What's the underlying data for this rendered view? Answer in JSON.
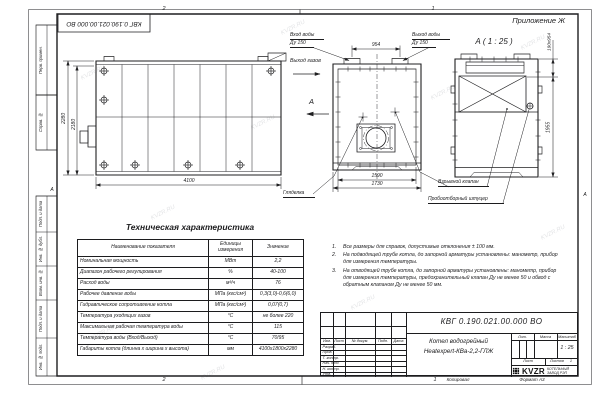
{
  "watermark": "KVZR.RU",
  "frame": {
    "doc_number_top": "КВГ 0.190.021.00.000 ВО",
    "appendix": "Приложение Ж",
    "zones": {
      "top_left": "2",
      "top_right": "1",
      "bottom_left": "2",
      "bottom_right": "1",
      "row_letter_left": "А",
      "row_letter_right": "А"
    },
    "margin_labels": [
      "Перв. примен.",
      "Справ. №",
      "Подп. и дата",
      "Инв. № дубл.",
      "Взам. инв. №",
      "Подп. и дата",
      "Инв. № подл."
    ]
  },
  "drawing": {
    "section_view_title": "А ( 1 : 25 )",
    "section_arrow_label": "А",
    "callouts": {
      "water_inlet_line1": "Вход воды",
      "water_inlet_line2": "Ду 150",
      "water_outlet_line1": "Выход воды",
      "water_outlet_line2": "Ду 150",
      "gas_outlet": "Выход газов",
      "sight_glass": "Гляделка",
      "explosion_valve": "Взрывной клапан",
      "sampling_fitting": "Пробоотборный штуцер"
    },
    "dimensions": {
      "nozzle_spacing": "954",
      "height_overall": "2280",
      "height_body": "2180",
      "length_overall": "4100",
      "front_width_inner": "1590",
      "front_width_overall": "1730",
      "valve_size": "190х954",
      "rear_height": "1955"
    }
  },
  "spec_table": {
    "title": "Техническая характеристика",
    "headers": {
      "name": "Наименование показателя",
      "units_line1": "Единицы",
      "units_line2": "измерения",
      "value": "Значение"
    },
    "rows": [
      {
        "name": "Номинальная мощность",
        "units": "МВт",
        "value": "2,2"
      },
      {
        "name": "Диапазон рабочего регулирования",
        "units": "%",
        "value": "40-100"
      },
      {
        "name": "Расход воды",
        "units": "м³/ч",
        "value": "76"
      },
      {
        "name": "Рабочее давление воды",
        "units": "МПа (кгс/см²)",
        "value": "0,3(3,0)-0,6(6,0)"
      },
      {
        "name": "Гидравлическое сопротивление котла",
        "units": "МПа (кгс/см²)",
        "value": "0,07(0,7)"
      },
      {
        "name": "Температура уходящих газов",
        "units": "°С",
        "value": "не более 220"
      },
      {
        "name": "Максимальная рабочая температура воды",
        "units": "°С",
        "value": "115"
      },
      {
        "name": "Температура воды (Вход/Выход)",
        "units": "°С",
        "value": "70/95"
      },
      {
        "name": "Габариты котла (длинна х ширина х высота)",
        "units": "мм",
        "value": "4100х1800х2280"
      }
    ]
  },
  "notes": [
    {
      "num": "1.",
      "text": "Все размеры для справок, допустимые отклонения ± 100 мм."
    },
    {
      "num": "2.",
      "text": "На подводящей трубе котла, до запорной арматуры установлены: манометр, прибор для измерения температуры."
    },
    {
      "num": "3.",
      "text": "На отводящей трубе котла, до запорной арматуры установлены: манометр, прибор для измерения температуры, предохранительный клапан Ду не менее 50 и обвод с обратным клапаном Ду не менее 50 мм."
    }
  ],
  "title_block": {
    "doc_number": "КВГ 0.190.021.00.000 ВО",
    "product_line1": "Котел водогрейный",
    "product_line2": "Heatexpert-КВа-2,2-ГЛЖ",
    "columns": [
      "Изм.",
      "Лист",
      "№ докум.",
      "Подп.",
      "Дата"
    ],
    "sign_rows": [
      "Разраб.",
      "Пров.",
      "Т. контр.",
      "Нач. отд.",
      "Н. контр.",
      "Утв."
    ],
    "lit_label": "Лит.",
    "mass_label": "Масса",
    "scale_label": "Масштаб",
    "scale_value": "1 : 25",
    "sheet_label": "Лист",
    "sheets_label": "Листов",
    "sheets_value": "1",
    "logo_text": "KVZR",
    "company_line1": "КОТЕЛЬНЫЙ",
    "company_line2": "ЗАВОД РЭП",
    "copied_label": "Копировал",
    "format_label": "Формат А3"
  }
}
